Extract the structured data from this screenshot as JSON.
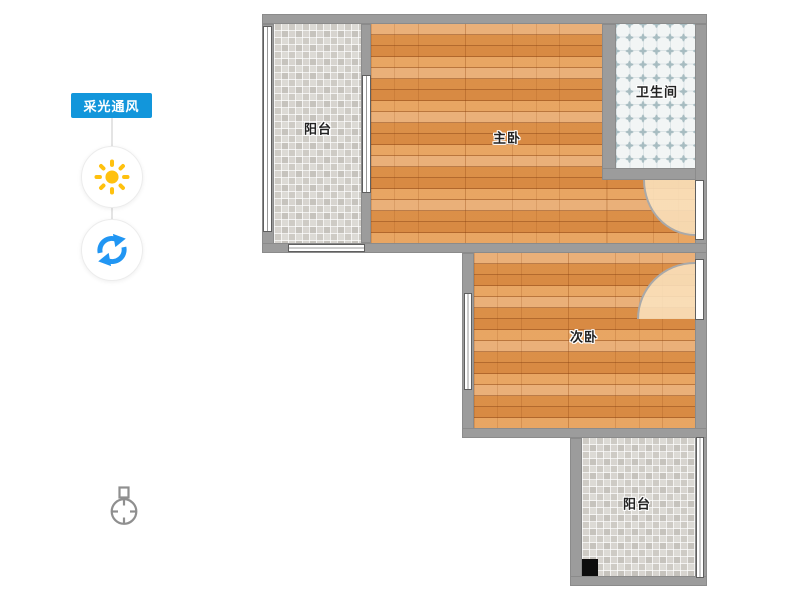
{
  "sidebar": {
    "badge": {
      "label": "采光通风",
      "color": "#1296db"
    },
    "buttons": [
      {
        "name": "sunlight",
        "icon": "sun-icon",
        "color": "#ffc10e"
      },
      {
        "name": "ventilation",
        "icon": "refresh-icon",
        "color": "#2196f3"
      }
    ]
  },
  "floorplan": {
    "rooms": [
      {
        "name": "balcony-top",
        "label": "阳台",
        "floor": "gray-tile"
      },
      {
        "name": "master-bedroom",
        "label": "主卧",
        "floor": "wood"
      },
      {
        "name": "bathroom",
        "label": "卫生间",
        "floor": "bath-tile"
      },
      {
        "name": "second-bedroom",
        "label": "次卧",
        "floor": "wood"
      },
      {
        "name": "balcony-bottom",
        "label": "阳台",
        "floor": "gray-tile"
      }
    ],
    "colors": {
      "wall": "#9b9b9b",
      "wood_floor": "#e2944a",
      "gray_tile": "#d2cfc9",
      "bath_tile": "#f2f5f5",
      "door_swing": "#f8debc",
      "label_text": "#222222"
    }
  },
  "compass": {
    "icon": "compass-north-icon"
  }
}
